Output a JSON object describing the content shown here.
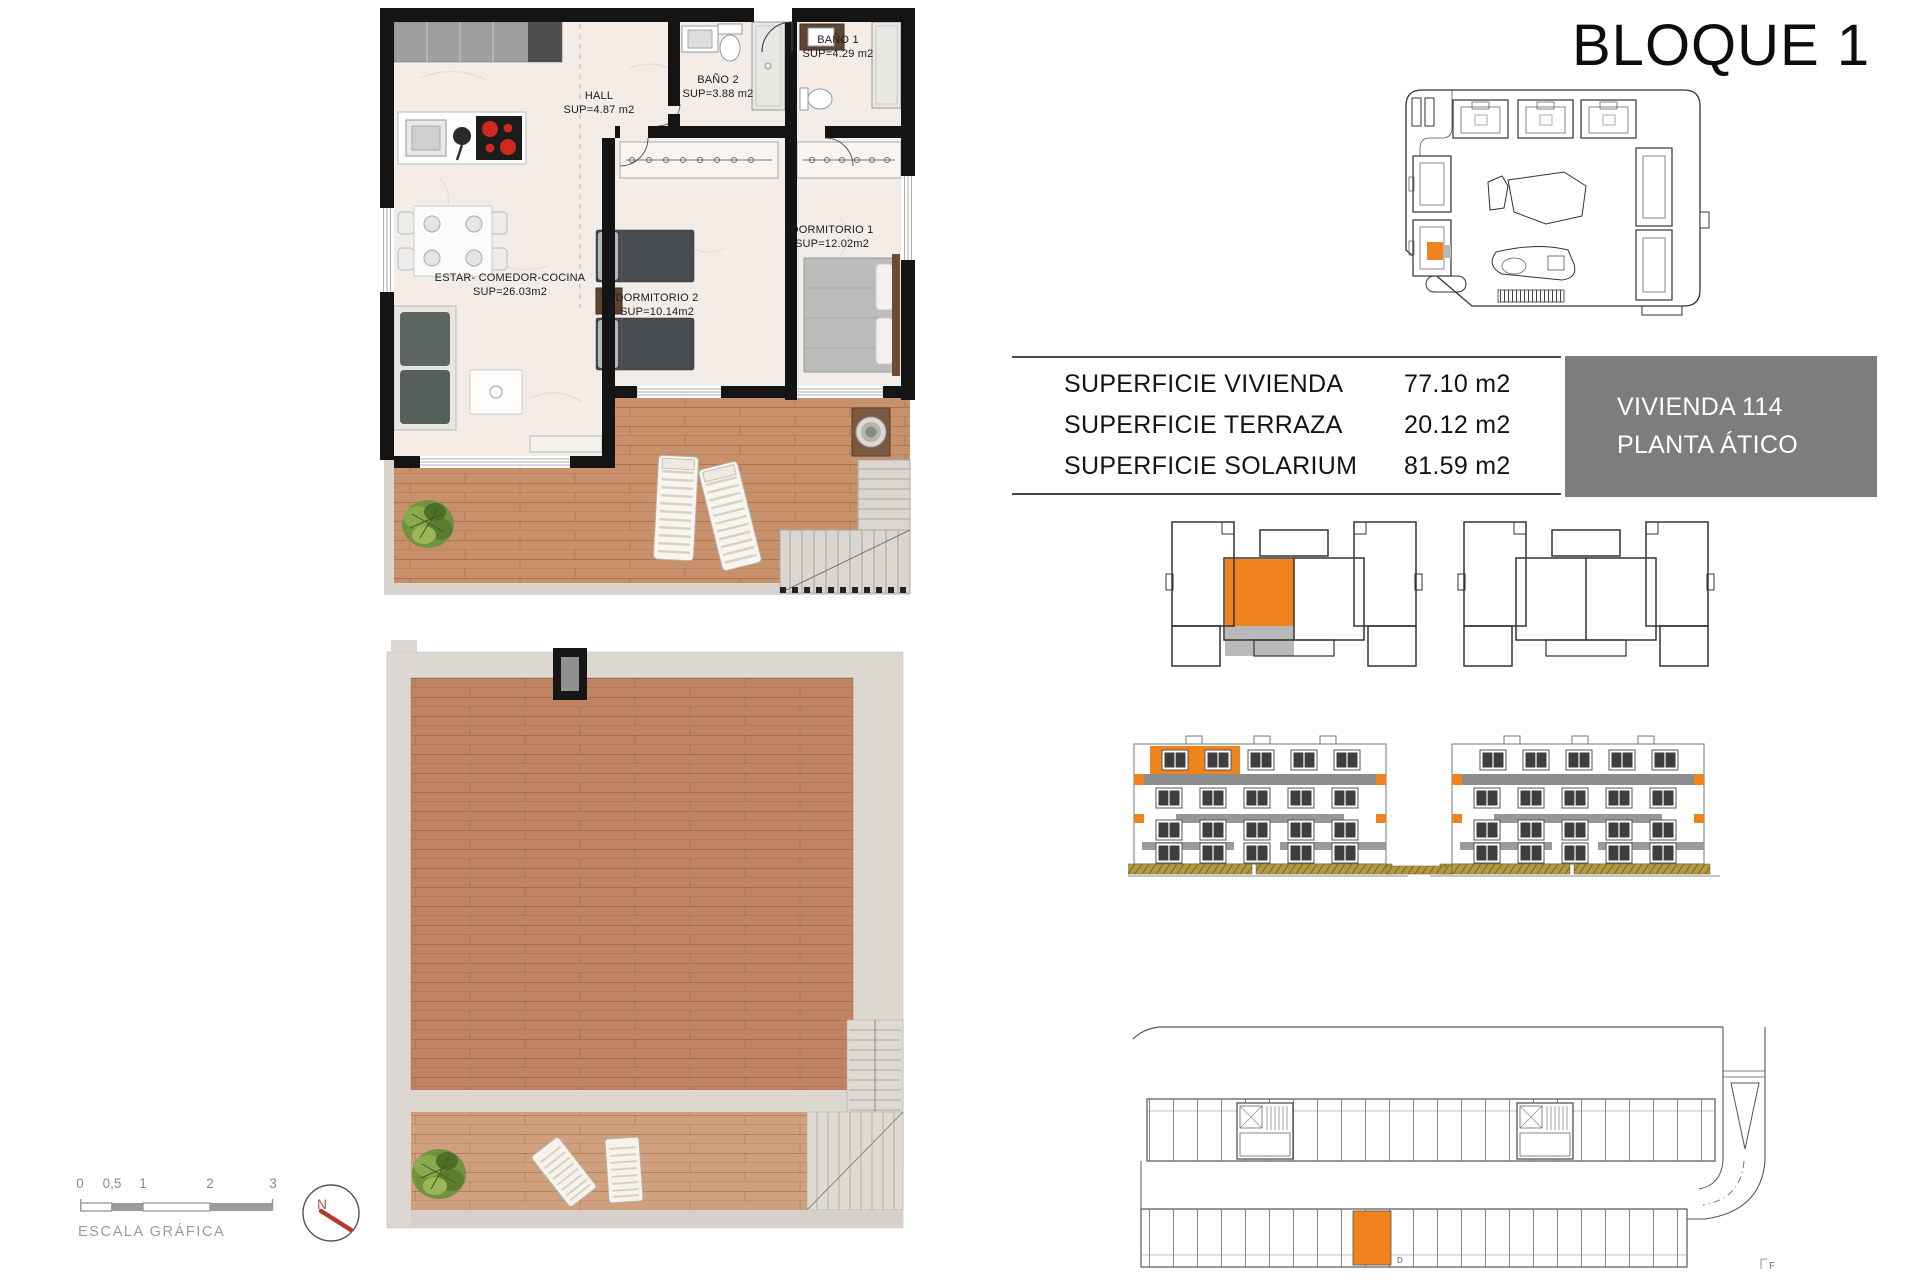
{
  "page": {
    "title": "BLOQUE 1"
  },
  "surface_table": {
    "rows": [
      {
        "label": "SUPERFICIE VIVIENDA",
        "value": "77.10 m2"
      },
      {
        "label": "SUPERFICIE TERRAZA",
        "value": "20.12 m2"
      },
      {
        "label": "SUPERFICIE SOLARIUM",
        "value": "81.59 m2"
      }
    ]
  },
  "unit_badge": {
    "line1": "VIVIENDA 114",
    "line2": "PLANTA ÁTICO"
  },
  "apartment_plan": {
    "rooms": [
      {
        "name": "HALL",
        "sup": "SUP=4.87 m2"
      },
      {
        "name": "BAÑO 2",
        "sup": "SUP=3.88 m2"
      },
      {
        "name": "BAÑO 1",
        "sup": "SUP=4.29 m2"
      },
      {
        "name": "DORMITORIO 1",
        "sup": "SUP=12.02m2"
      },
      {
        "name": "DORMITORIO 2",
        "sup": "SUP=10.14m2"
      },
      {
        "name": "ESTAR- COMEDOR-COCINA",
        "sup": "SUP=26.03m2"
      }
    ]
  },
  "scale_bar": {
    "ticks": [
      "0",
      "0,5",
      "1",
      "2",
      "3"
    ],
    "label": "ESCALA GRÁFICA"
  },
  "compass": {
    "north_label": "N"
  },
  "garage_plan": {
    "space_label": "D",
    "corner_mark": "F"
  },
  "colors": {
    "highlight_orange": "#EF831E",
    "badge_gray": "#7D7D7D",
    "needle_red": "#B23B2C",
    "wood_terrace": "#C9906C",
    "wood_solarium": "#C08463",
    "concrete_gray": "#DCD8D1",
    "ground_olive": "#B19A43",
    "wall_black": "#141414",
    "window_dark": "#3E3E3E",
    "balcony_band_gray": "#8D8D8D"
  }
}
